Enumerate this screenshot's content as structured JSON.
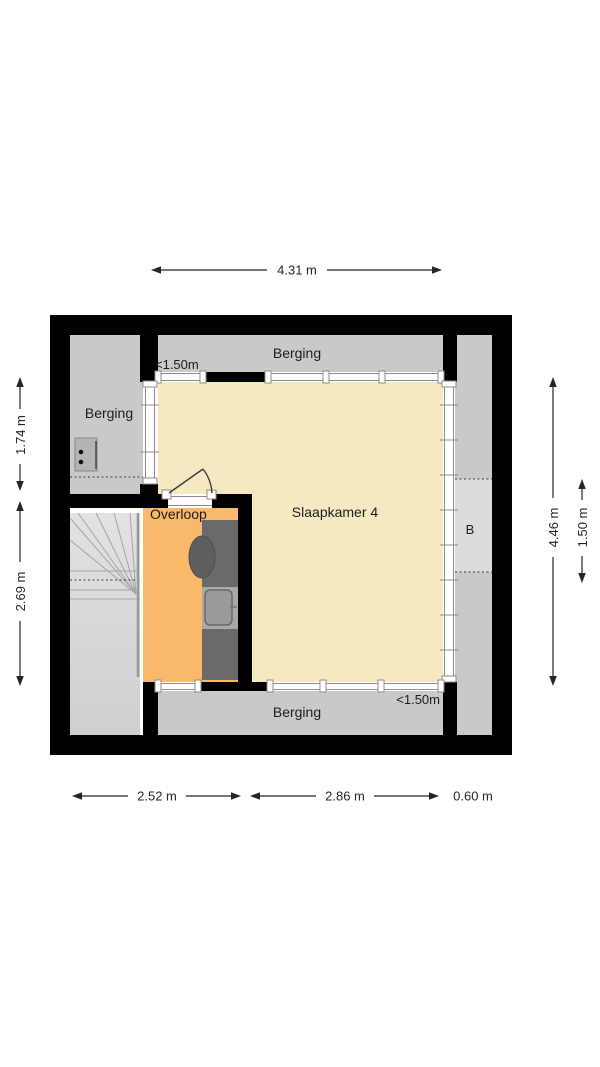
{
  "plan": {
    "title": "floor-plan-attic",
    "rooms": {
      "berging_left": {
        "label": "Berging"
      },
      "berging_top": {
        "label": "Berging"
      },
      "berging_bottom": {
        "label": "Berging"
      },
      "slaapkamer": {
        "label": "Slaapkamer 4"
      },
      "overloop": {
        "label": "Overloop"
      },
      "zone_b": {
        "label": "B"
      }
    },
    "headroom": {
      "top": "<1.50m",
      "bottom": "<1.50m"
    },
    "dimensions": {
      "top": "4.31 m",
      "bottom_left": "2.52 m",
      "bottom_middle": "2.86 m",
      "bottom_right": "0.60 m",
      "left_upper": "1.74 m",
      "left_lower": "2.69 m",
      "right_outer": "4.46 m",
      "right_inner": "1.50 m"
    },
    "colors": {
      "wall": "#000000",
      "bedroom_fill": "#f6e9c2",
      "landing_fill": "#f8ba6a",
      "storage_fill": "#c9c9c8",
      "zone_b_fill": "#dcdcdb",
      "stairs_fill": "#d6d6d6",
      "unit_dark": "#6a6a6a"
    }
  }
}
